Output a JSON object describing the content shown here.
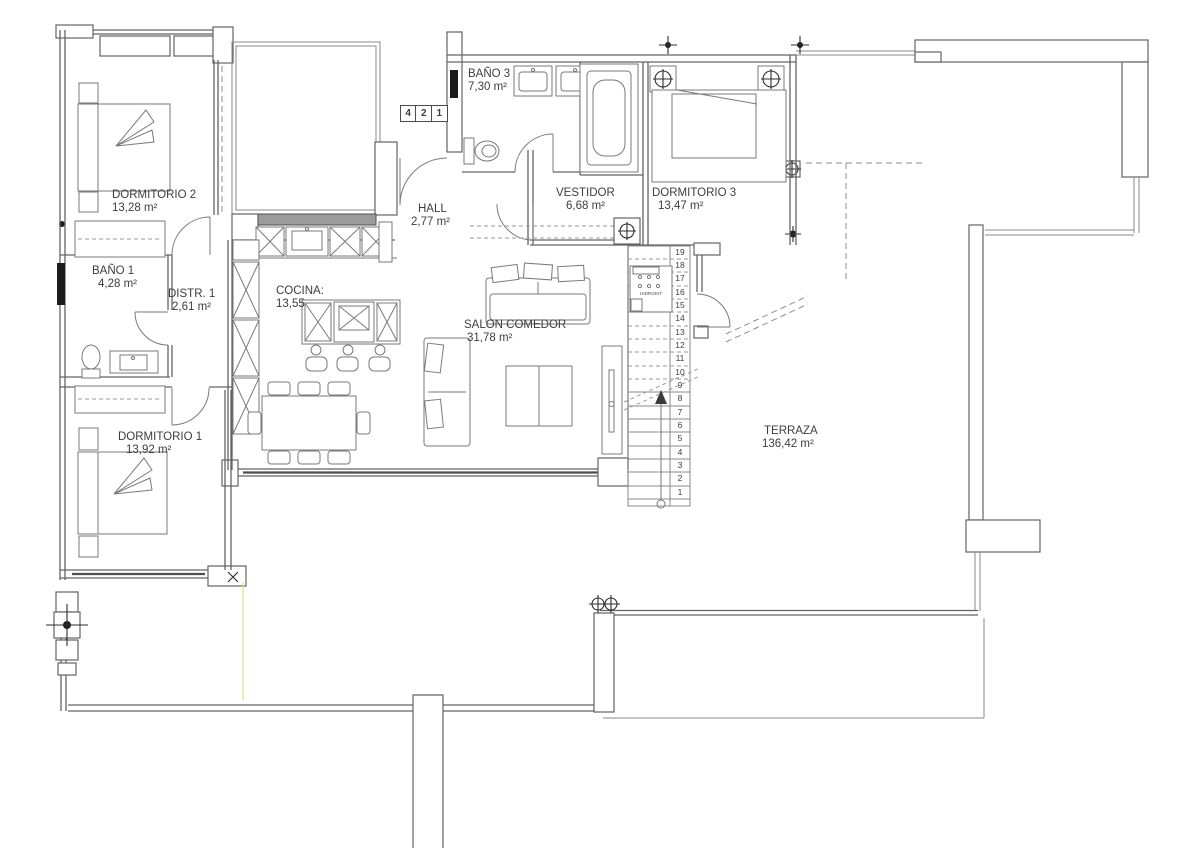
{
  "rooms": {
    "dormitorio2": {
      "name": "DORMITORIO 2",
      "area": "13,28 m²"
    },
    "bano1": {
      "name": "BAÑO 1",
      "area": "4,28 m²"
    },
    "distribuidor": {
      "name": "DISTR. 1",
      "area": "2,61 m²"
    },
    "cocina": {
      "name": "COCINA:",
      "area": "13,55"
    },
    "hall": {
      "name": "HALL",
      "area": "2,77 m²"
    },
    "bano3": {
      "name": "BAÑO 3",
      "area": "7,30 m²"
    },
    "vestidor": {
      "name": "VESTIDOR",
      "area": "6,68 m²"
    },
    "dormitorio3": {
      "name": "DORMITORIO 3",
      "area": "13,47 m²"
    },
    "salon": {
      "name": "SALON COMEDOR",
      "area": "31,78 m²"
    },
    "dormitorio1": {
      "name": "DORMITORIO 1",
      "area": "13,92 m²"
    },
    "terraza": {
      "name": "TERRAZA",
      "area": "136,42 m²"
    }
  },
  "unit_badge": {
    "digits": [
      "4",
      "2",
      "1"
    ]
  },
  "stairs": {
    "steps": [
      "1",
      "2",
      "3",
      "4",
      "5",
      "6",
      "7",
      "8",
      "9",
      "10",
      "11",
      "12",
      "13",
      "14",
      "15",
      "16",
      "17",
      "18",
      "19"
    ],
    "equipment_label": "HIDROKIT"
  },
  "colors": {
    "wall_line": "#636363",
    "furniture_line": "#7a7a7a",
    "text": "#3d3d3d",
    "highlight": "#e9df96",
    "window_dark": "#1c1c1c"
  }
}
